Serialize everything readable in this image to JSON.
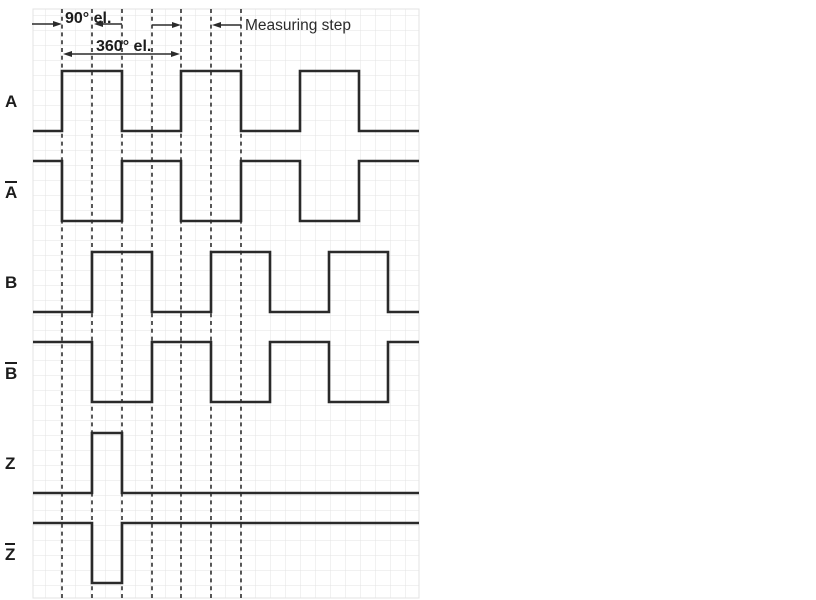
{
  "colors": {
    "background": "#ffffff",
    "signal": "#2a2a2a",
    "dashed_line": "#3c3c3c",
    "grid_line": "#e3e3e3",
    "text": "#1c1c1c"
  },
  "grid": {
    "left": 33,
    "top": 9,
    "width": 386,
    "height": 589,
    "cell_size": 15
  },
  "dashed_lines_x": [
    62,
    92,
    122,
    152,
    181,
    211,
    241
  ],
  "annotations": {
    "deg90": {
      "label": "90° el."
    },
    "deg360": {
      "label": "360° el."
    },
    "measuring_step": {
      "label": "Measuring step"
    }
  },
  "signals": [
    {
      "label": "A",
      "overline": false,
      "high_y": 71,
      "low_y": 131,
      "start_level": "low",
      "transitions_x": [
        62,
        122,
        181,
        241,
        300,
        359
      ]
    },
    {
      "label": "A",
      "overline": true,
      "high_y": 161,
      "low_y": 221,
      "start_level": "high",
      "transitions_x": [
        62,
        122,
        181,
        241,
        300,
        359
      ]
    },
    {
      "label": "B",
      "overline": false,
      "high_y": 252,
      "low_y": 312,
      "start_level": "low",
      "transitions_x": [
        92,
        152,
        211,
        270,
        329,
        388
      ]
    },
    {
      "label": "B",
      "overline": true,
      "high_y": 342,
      "low_y": 402,
      "start_level": "high",
      "transitions_x": [
        92,
        152,
        211,
        270,
        329,
        388
      ]
    },
    {
      "label": "Z",
      "overline": false,
      "high_y": 433,
      "low_y": 493,
      "start_level": "low",
      "transitions_x": [
        92,
        122
      ]
    },
    {
      "label": "Z",
      "overline": true,
      "high_y": 523,
      "low_y": 583,
      "start_level": "high",
      "transitions_x": [
        92,
        122
      ]
    }
  ]
}
